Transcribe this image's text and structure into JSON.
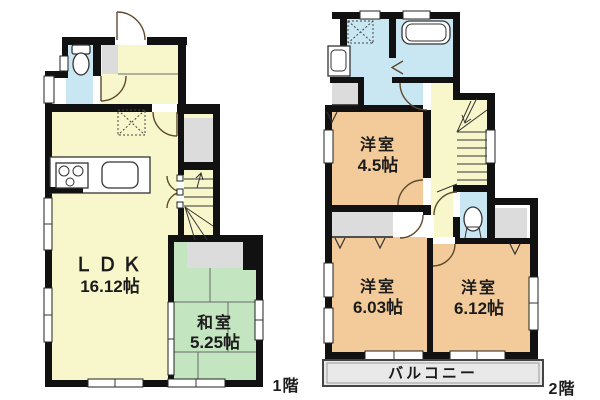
{
  "floorplan": {
    "floor1": {
      "label": "1階",
      "ldk": {
        "name": "ＬＤＫ",
        "size": "16.12帖"
      },
      "washitsu": {
        "name": "和室",
        "size": "5.25帖"
      }
    },
    "floor2": {
      "label": "2階",
      "room_45": {
        "name": "洋室",
        "size": "4.5帖"
      },
      "room_603": {
        "name": "洋室",
        "size": "6.03帖"
      },
      "room_612": {
        "name": "洋室",
        "size": "6.12帖"
      },
      "balcony": {
        "label": "バルコニー"
      }
    },
    "colors": {
      "room_yellow": "#f8f7cb",
      "tatami_green": "#c3e5c0",
      "western_orange": "#f3cb9a",
      "water_blue": "#c9e7f2",
      "closet_gray": "#dcdcdc",
      "balcony_gray": "#e9e9e9",
      "wall_black": "#111111"
    }
  }
}
